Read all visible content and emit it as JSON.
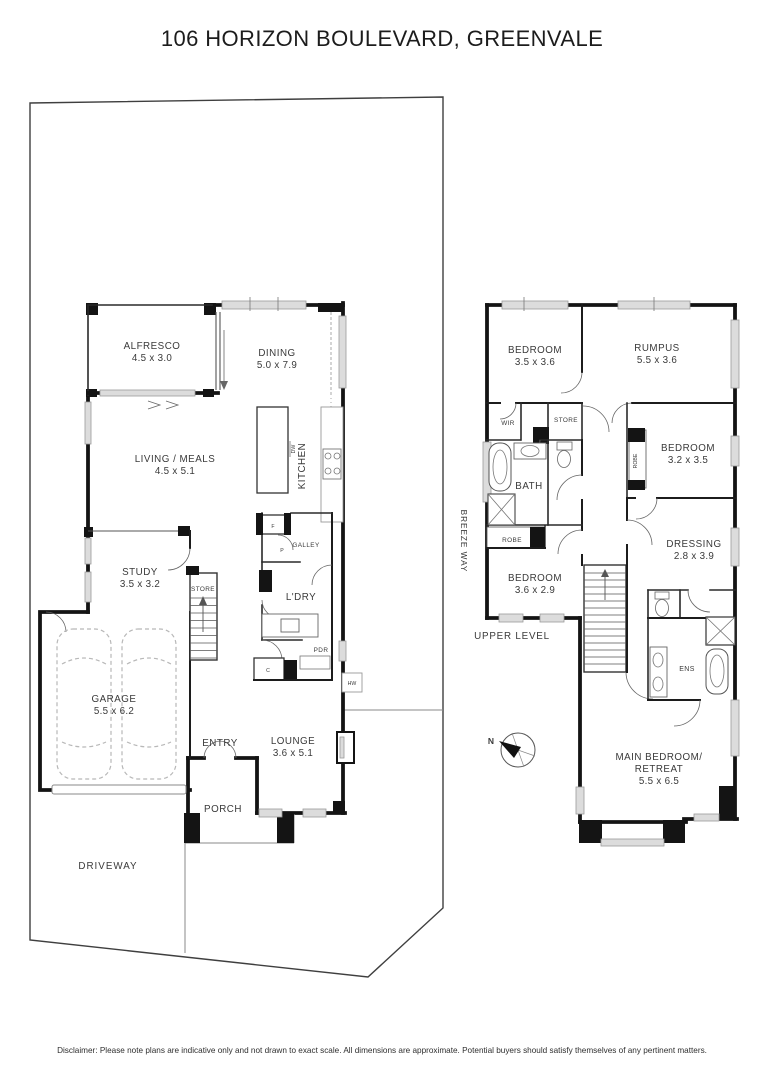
{
  "title": "106 HORIZON BOULEVARD, GREENVALE",
  "disclaimer": "Disclaimer: Please note plans are indicative only and not drawn to exact scale. All dimensions are approximate. Potential buyers should satisfy themselves of any pertinent matters.",
  "site": {
    "breezeway": "BREEZE WAY",
    "driveway": "DRIVEWAY",
    "compass_north": "N"
  },
  "ground_floor": {
    "alfresco": {
      "name": "ALFRESCO",
      "dims": "4.5 x 3.0"
    },
    "dining": {
      "name": "DINING",
      "dims": "5.0 x 7.9"
    },
    "living_meals": {
      "name": "LIVING / MEALS",
      "dims": "4.5 x 5.1"
    },
    "kitchen": {
      "name": "KITCHEN"
    },
    "dishwasher": "DW",
    "study": {
      "name": "STUDY",
      "dims": "3.5 x 3.2"
    },
    "store": "STORE",
    "galley": "GALLEY",
    "fridge": "F",
    "pantry": "P",
    "laundry": "L'DRY",
    "powder": "PDR",
    "cupboard": "C",
    "hot_water": "HW",
    "garage": {
      "name": "GARAGE",
      "dims": "5.5 x 6.2"
    },
    "entry": "ENTRY",
    "lounge": {
      "name": "LOUNGE",
      "dims": "3.6 x 5.1"
    },
    "porch": "PORCH"
  },
  "upper_floor": {
    "level_label": "UPPER LEVEL",
    "bedroom1": {
      "name": "BEDROOM",
      "dims": "3.5 x 3.6"
    },
    "rumpus": {
      "name": "RUMPUS",
      "dims": "5.5 x 3.6"
    },
    "bedroom2": {
      "name": "BEDROOM",
      "dims": "3.2 x 3.5"
    },
    "robe_bedroom2": "ROBE",
    "wir": "WIR",
    "store": "STORE",
    "bath": "BATH",
    "robe_bedroom3": "ROBE",
    "bedroom3": {
      "name": "BEDROOM",
      "dims": "3.6 x 2.9"
    },
    "dressing": {
      "name": "DRESSING",
      "dims": "2.8 x 3.9"
    },
    "ensuite": "ENS",
    "main_bedroom": {
      "name_line1": "MAIN BEDROOM/",
      "name_line2": "RETREAT",
      "dims": "5.5 x 6.5"
    }
  }
}
